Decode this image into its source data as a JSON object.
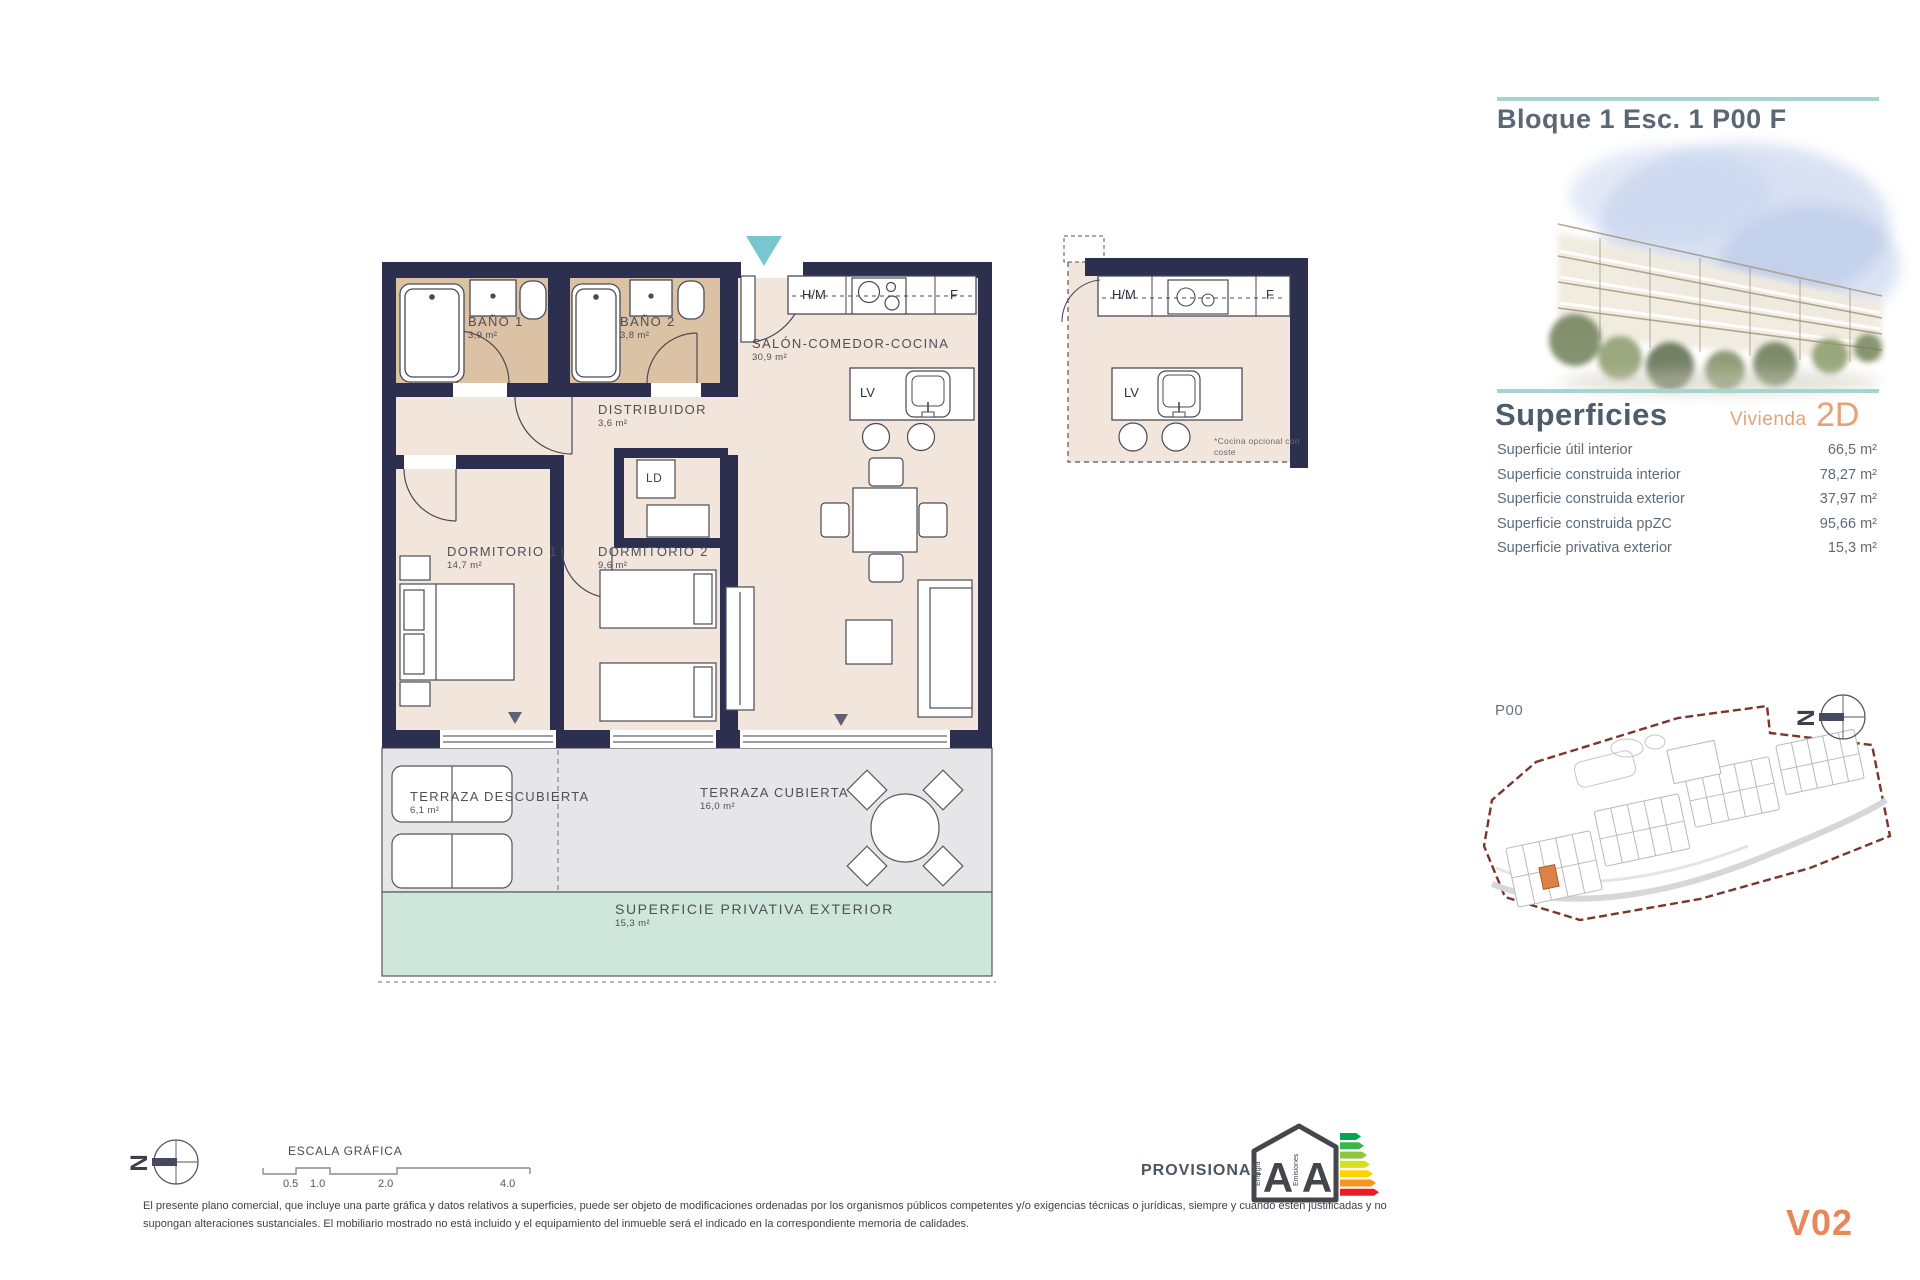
{
  "colors": {
    "accent_teal": "#a5d5d1",
    "accent_orange": "#e7a176",
    "wall_navy": "#2d2f4e",
    "bathroom_floor_tan": "#dcc2a4",
    "interior_floor": "#f2e5dc",
    "terrace_gray": "#e6e6e8",
    "exterior_green": "#cfe7db",
    "entrance_arrow_teal": "#79c6d1",
    "site_highlight_orange": "#dd8146",
    "version_orange": "#e8885a"
  },
  "header": {
    "title": "Bloque 1 Esc. 1 P00 F"
  },
  "superficies": {
    "title": "Superficies",
    "vivienda_label": "Vivienda",
    "vivienda_code": "2D",
    "rows": [
      {
        "label": "Superficie útil interior",
        "value": "66,5 m²"
      },
      {
        "label": "Superficie construida interior",
        "value": "78,27 m²"
      },
      {
        "label": "Superficie construida exterior",
        "value": "37,97 m²"
      },
      {
        "label": "Superficie construida ppZC",
        "value": "95,66 m²"
      },
      {
        "label": "Superficie privativa exterior",
        "value": "15,3 m²"
      }
    ]
  },
  "site_plan": {
    "floor_label": "P00"
  },
  "floor_plan": {
    "rooms": [
      {
        "name": "BAÑO 1",
        "area": "3,9 m²"
      },
      {
        "name": "BAÑO 2",
        "area": "3,8 m²"
      },
      {
        "name": "SALÓN-COMEDOR-COCINA",
        "area": "30,9 m²"
      },
      {
        "name": "DISTRIBUIDOR",
        "area": "3,6 m²"
      },
      {
        "name": "DORMITORIO 1",
        "area": "14,7 m²"
      },
      {
        "name": "DORMITORIO 2",
        "area": "9,6 m²"
      },
      {
        "name": "TERRAZA DESCUBIERTA",
        "area": "6,1 m²"
      },
      {
        "name": "TERRAZA CUBIERTA",
        "area": "16,0 m²"
      },
      {
        "name": "SUPERFICIE PRIVATIVA EXTERIOR",
        "area": "15,3 m²"
      }
    ],
    "labels": {
      "laundry": "LD",
      "hm": "H/M",
      "fridge": "F",
      "dishwasher": "LV"
    },
    "detail_kitchen": {
      "hm": "H/M",
      "fridge": "F",
      "dishwasher": "LV",
      "note": "*Cocina opcional con coste"
    }
  },
  "footer": {
    "scale_title": "ESCALA GRÁFICA",
    "scale_ticks": [
      "0.5",
      "1.0",
      "2.0",
      "4.0"
    ],
    "provisional": "PROVISIONAL",
    "energy": {
      "letter_left": "A",
      "letter_right": "A",
      "caption_left": "Energía",
      "caption_right": "Emisiones"
    },
    "north_letter": "N",
    "disclaimer": "El presente plano comercial, que incluye una parte gráfica y datos relativos a superficies, puede ser objeto de modificaciones ordenadas por los organismos públicos competentes y/o exigencias técnicas o jurídicas, siempre y cuando estén justificadas y no supongan alteraciones sustanciales. El mobiliario mostrado no está incluido y el equipamiento del inmueble será el indicado en la correspondiente memoria de calidades.",
    "version": "V02"
  }
}
